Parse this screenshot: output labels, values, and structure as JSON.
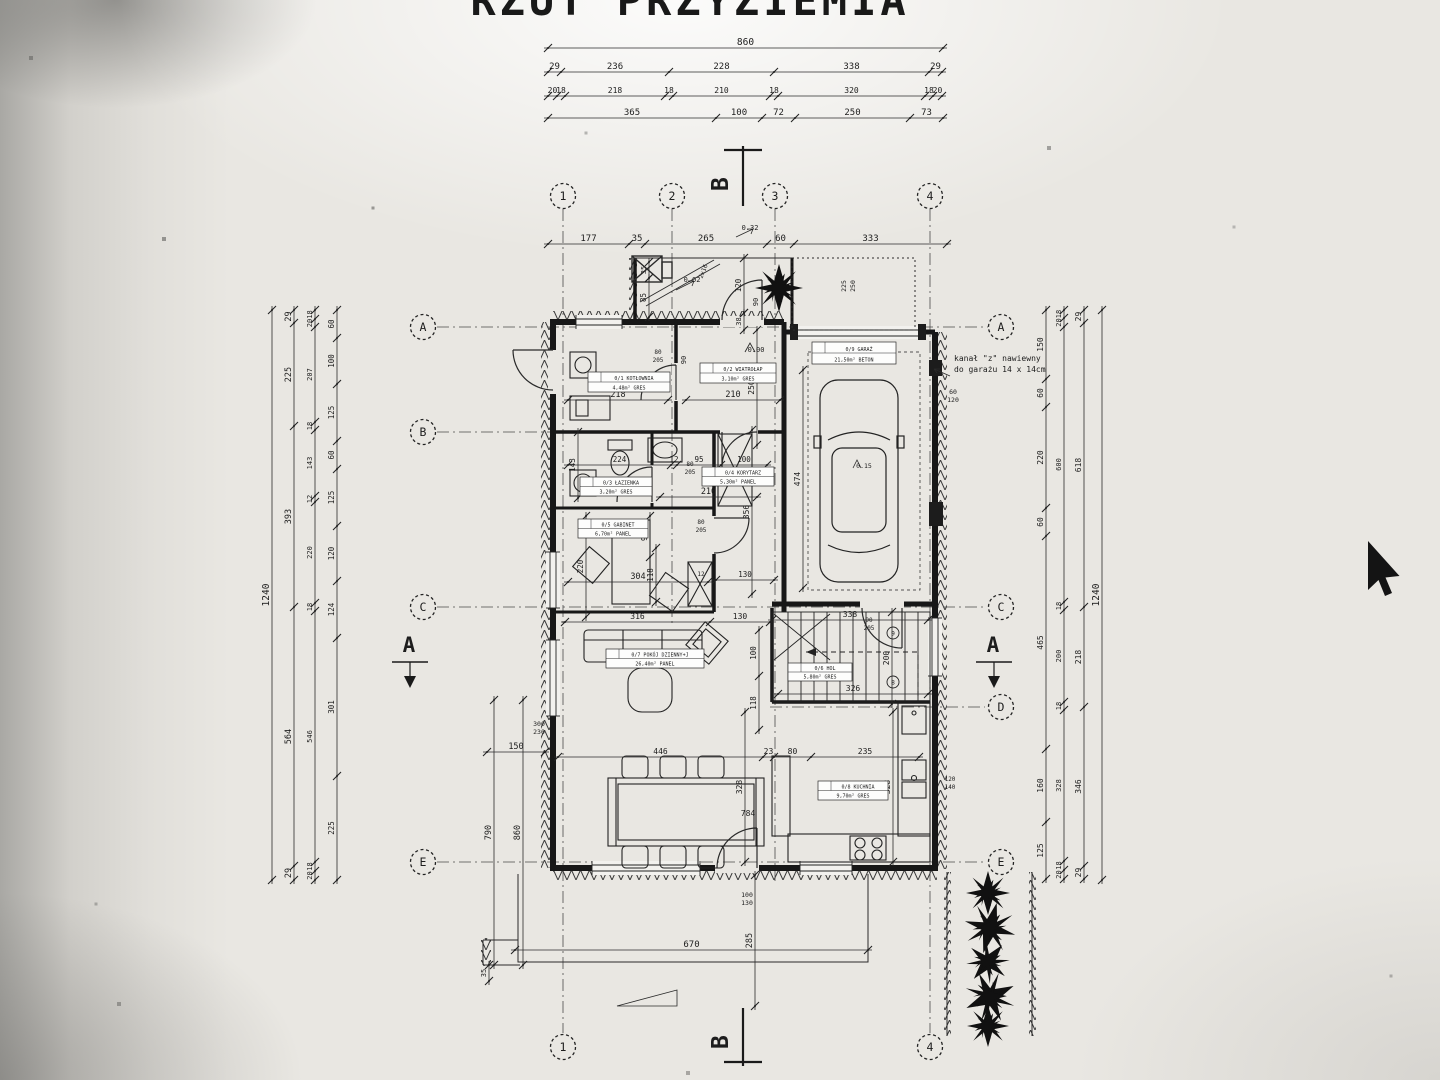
{
  "title": "RZUT PRZYZIEMIA",
  "note": {
    "line1": "kanał \"z\" nawiewny",
    "line2": "do garażu 14 x 14cm"
  },
  "grid": {
    "bubbles": [
      {
        "t": "1",
        "x": 563,
        "y": 196
      },
      {
        "t": "2",
        "x": 672,
        "y": 196
      },
      {
        "t": "3",
        "x": 775,
        "y": 196
      },
      {
        "t": "4",
        "x": 930,
        "y": 196
      },
      {
        "t": "A",
        "x": 423,
        "y": 327
      },
      {
        "t": "B",
        "x": 423,
        "y": 432
      },
      {
        "t": "C",
        "x": 423,
        "y": 607
      },
      {
        "t": "E",
        "x": 423,
        "y": 862
      },
      {
        "t": "A",
        "x": 1001,
        "y": 327
      },
      {
        "t": "C",
        "x": 1001,
        "y": 607
      },
      {
        "t": "D",
        "x": 1001,
        "y": 707
      },
      {
        "t": "E",
        "x": 1001,
        "y": 862
      },
      {
        "t": "1",
        "x": 563,
        "y": 1047
      },
      {
        "t": "4",
        "x": 930,
        "y": 1047
      }
    ]
  },
  "chains": [
    {
      "v": 0,
      "p": 48,
      "b": [
        548,
        943
      ],
      "l": [
        "860"
      ],
      "s": 9.5
    },
    {
      "v": 0,
      "p": 72,
      "b": [
        548,
        561,
        669,
        774,
        929,
        942
      ],
      "l": [
        "29",
        "236",
        "228",
        "338",
        "29"
      ],
      "s": 9
    },
    {
      "v": 0,
      "p": 96,
      "b": [
        548,
        557,
        565,
        665,
        673,
        770,
        778,
        925,
        933,
        942
      ],
      "l": [
        "20",
        "18",
        "218",
        "18",
        "210",
        "18",
        "320",
        "18",
        "20"
      ],
      "s": 8
    },
    {
      "v": 0,
      "p": 118,
      "b": [
        548,
        716,
        762,
        795,
        910,
        943
      ],
      "l": [
        "365",
        "100",
        "72",
        "250",
        "73"
      ],
      "s": 9
    },
    {
      "v": 0,
      "p": 244,
      "b": [
        548,
        629,
        645,
        767,
        794,
        947
      ],
      "l": [
        "177",
        "35",
        "265",
        "60",
        "333"
      ],
      "s": 9
    },
    {
      "v": 0,
      "p": 752,
      "b": [
        487,
        545
      ],
      "l": [
        "150"
      ],
      "s": 8.5
    },
    {
      "v": 0,
      "p": 950,
      "b": [
        515,
        868
      ],
      "l": [
        "670"
      ],
      "s": 9
    },
    {
      "v": 0,
      "p": 400,
      "b": [
        568,
        668
      ],
      "l": [
        "218"
      ],
      "s": 8.5
    },
    {
      "v": 0,
      "p": 400,
      "b": [
        686,
        780
      ],
      "l": [
        "210"
      ],
      "s": 8.5
    },
    {
      "v": 0,
      "p": 497,
      "b": [
        660,
        757
      ],
      "l": [
        "210"
      ],
      "s": 8.5
    },
    {
      "v": 0,
      "p": 465,
      "b": [
        568,
        671,
        677,
        721,
        767
      ],
      "l": [
        "224",
        "12",
        "95",
        "100"
      ],
      "s": 7.5
    },
    {
      "v": 0,
      "p": 582,
      "b": [
        568,
        708
      ],
      "l": [
        "304"
      ],
      "s": 8.5
    },
    {
      "v": 0,
      "p": 622,
      "b": [
        565,
        710,
        770
      ],
      "l": [
        "316",
        "130"
      ],
      "s": 8
    },
    {
      "v": 0,
      "p": 580,
      "b": [
        716,
        774
      ],
      "l": [
        "130"
      ],
      "s": 7.5
    },
    {
      "v": 0,
      "p": 757,
      "b": [
        558,
        763,
        774,
        811,
        919
      ],
      "l": [
        "446",
        "23",
        "80",
        "235"
      ],
      "s": 8
    },
    {
      "v": 0,
      "p": 620,
      "b": [
        772,
        928
      ],
      "l": [
        "338"
      ],
      "s": 8
    },
    {
      "v": 0,
      "p": 694,
      "b": [
        778,
        928
      ],
      "l": [
        "326"
      ],
      "s": 8
    },
    {
      "v": 1,
      "p": 272,
      "b": [
        310,
        880
      ],
      "l": [
        "1240"
      ],
      "s": 9.5
    },
    {
      "v": 1,
      "p": 294,
      "b": [
        310,
        323,
        426,
        607,
        866,
        880
      ],
      "l": [
        "29",
        "225",
        "393",
        "564",
        "29"
      ],
      "s": 8.5
    },
    {
      "v": 1,
      "p": 315,
      "b": [
        310,
        319,
        327,
        422,
        430,
        496,
        502,
        603,
        611,
        862,
        871,
        880
      ],
      "l": [
        "18",
        "20",
        "207",
        "18",
        "143",
        "12",
        "220",
        "18",
        "546",
        "18",
        "20"
      ],
      "s": 7
    },
    {
      "v": 1,
      "p": 337,
      "b": [
        310,
        338,
        384,
        441,
        469,
        526,
        581,
        638,
        776,
        880
      ],
      "l": [
        "60",
        "100",
        "125",
        "60",
        "125",
        "120",
        "124",
        "301",
        "225"
      ],
      "s": 7.5
    },
    {
      "v": 1,
      "p": 1046,
      "b": [
        310,
        379,
        407,
        508,
        536,
        749,
        822,
        879
      ],
      "l": [
        "150",
        "60",
        "220",
        "60",
        "465",
        "160",
        "125"
      ],
      "s": 8
    },
    {
      "v": 1,
      "p": 1064,
      "b": [
        310,
        318,
        327,
        602,
        610,
        702,
        710,
        861,
        870,
        879
      ],
      "l": [
        "18",
        "20",
        "600",
        "18",
        "200",
        "18",
        "328",
        "18",
        "20"
      ],
      "s": 7
    },
    {
      "v": 1,
      "p": 1084,
      "b": [
        310,
        323,
        607,
        707,
        866,
        879
      ],
      "l": [
        "29",
        "618",
        "218",
        "346",
        "29"
      ],
      "s": 8
    },
    {
      "v": 1,
      "p": 1102,
      "b": [
        310,
        880
      ],
      "l": [
        "1240"
      ],
      "s": 9.5
    },
    {
      "v": 1,
      "p": 494,
      "b": [
        700,
        965
      ],
      "l": [
        "790"
      ],
      "s": 8.5
    },
    {
      "v": 1,
      "p": 523,
      "b": [
        700,
        965
      ],
      "l": [
        "860"
      ],
      "s": 8.5
    },
    {
      "v": 1,
      "p": 755,
      "b": [
        875,
        1006
      ],
      "l": [
        "285"
      ],
      "s": 8.5
    },
    {
      "v": 1,
      "p": 489,
      "b": [
        965,
        981
      ],
      "l": [
        "35"
      ],
      "s": 7
    },
    {
      "v": 1,
      "p": 803,
      "b": [
        370,
        588
      ],
      "l": [
        "474"
      ],
      "s": 8
    },
    {
      "v": 1,
      "p": 892,
      "b": [
        612,
        704
      ],
      "l": [
        "200"
      ],
      "s": 8
    },
    {
      "v": 1,
      "p": 757,
      "b": [
        330,
        445
      ],
      "l": [
        "250"
      ],
      "s": 8
    },
    {
      "v": 1,
      "p": 759,
      "b": [
        630,
        676,
        730
      ],
      "l": [
        "100",
        "118"
      ],
      "s": 7.5
    },
    {
      "v": 1,
      "p": 745,
      "b": [
        712,
        862
      ],
      "l": [
        "328"
      ],
      "s": 8
    },
    {
      "v": 1,
      "p": 893,
      "b": [
        712,
        862
      ],
      "l": [
        "328"
      ],
      "s": 8
    },
    {
      "v": 1,
      "p": 752,
      "b": [
        430,
        594
      ],
      "l": [
        "356"
      ],
      "s": 8
    },
    {
      "v": 1,
      "p": 650,
      "b": [
        516,
        557
      ],
      "l": [
        "90"
      ],
      "s": 7.5
    },
    {
      "v": 1,
      "p": 586,
      "b": [
        516,
        617
      ],
      "l": [
        "220"
      ],
      "s": 7.5
    },
    {
      "v": 1,
      "p": 656,
      "b": [
        548,
        602
      ],
      "l": [
        "118"
      ],
      "s": 7.5
    },
    {
      "v": 1,
      "p": 578,
      "b": [
        432,
        498
      ],
      "l": [
        "143"
      ],
      "s": 7.5
    },
    {
      "v": 1,
      "p": 649,
      "b": [
        262,
        278
      ],
      "l": [
        "35"
      ],
      "s": 7
    },
    {
      "v": 1,
      "p": 649,
      "b": [
        278,
        317
      ],
      "l": [
        "85"
      ],
      "s": 7.5
    },
    {
      "v": 1,
      "p": 744,
      "b": [
        258,
        313
      ],
      "l": [
        "120"
      ],
      "s": 7.5
    },
    {
      "v": 1,
      "p": 744,
      "b": [
        313,
        330
      ],
      "l": [
        "38"
      ],
      "s": 7
    }
  ],
  "labels": [
    {
      "t": "B",
      "x": 728,
      "y": 184,
      "r": -90,
      "s": 23,
      "bold": 1
    },
    {
      "t": "B",
      "x": 728,
      "y": 1042,
      "r": -90,
      "s": 23,
      "bold": 1
    },
    {
      "t": "A",
      "x": 409,
      "y": 652,
      "s": 21,
      "bold": 1
    },
    {
      "t": "A",
      "x": 993,
      "y": 652,
      "s": 21,
      "bold": 1
    },
    {
      "t": "2x16",
      "x": 705,
      "y": 272,
      "r": -68,
      "s": 6
    },
    {
      "t": "0.02",
      "x": 692,
      "y": 282,
      "s": 7
    },
    {
      "t": "0.32",
      "x": 750,
      "y": 230,
      "s": 7
    },
    {
      "t": "0.00",
      "x": 756,
      "y": 352,
      "s": 7
    },
    {
      "t": "0.15",
      "x": 864,
      "y": 468,
      "s": 6.5
    },
    {
      "t": "90",
      "x": 686,
      "y": 360,
      "r": -90,
      "s": 7
    },
    {
      "t": "80",
      "x": 658,
      "y": 354,
      "s": 6
    },
    {
      "t": "205",
      "x": 658,
      "y": 362,
      "s": 6
    },
    {
      "t": "80",
      "x": 690,
      "y": 466,
      "s": 6
    },
    {
      "t": "205",
      "x": 690,
      "y": 474,
      "s": 6
    },
    {
      "t": "80",
      "x": 701,
      "y": 524,
      "s": 6
    },
    {
      "t": "205",
      "x": 701,
      "y": 532,
      "s": 6
    },
    {
      "t": "90",
      "x": 869,
      "y": 622,
      "s": 6
    },
    {
      "t": "205",
      "x": 869,
      "y": 630,
      "s": 6
    },
    {
      "t": "90",
      "x": 758,
      "y": 302,
      "r": -90,
      "s": 7
    },
    {
      "t": "60",
      "x": 953,
      "y": 394,
      "s": 6.5
    },
    {
      "t": "120",
      "x": 953,
      "y": 402,
      "s": 6.5
    },
    {
      "t": "225",
      "x": 846,
      "y": 286,
      "r": -90,
      "s": 6.5
    },
    {
      "t": "250",
      "x": 855,
      "y": 286,
      "r": -90,
      "s": 6.5
    },
    {
      "t": "784",
      "x": 748,
      "y": 816,
      "s": 8
    },
    {
      "t": "120",
      "x": 950,
      "y": 781,
      "s": 6
    },
    {
      "t": "140",
      "x": 950,
      "y": 789,
      "s": 6
    },
    {
      "t": "300",
      "x": 539,
      "y": 726,
      "s": 6.5
    },
    {
      "t": "230",
      "x": 539,
      "y": 734,
      "s": 6.5
    },
    {
      "t": "100",
      "x": 747,
      "y": 897,
      "s": 6.5
    },
    {
      "t": "130",
      "x": 747,
      "y": 905,
      "s": 6.5
    },
    {
      "t": "12",
      "x": 701,
      "y": 576,
      "s": 6
    },
    {
      "t": "9",
      "x": 893,
      "y": 635.5,
      "s": 6
    },
    {
      "t": "8",
      "x": 893,
      "y": 684.5,
      "s": 6
    },
    {
      "t": "kanał \"z\" nawiewny",
      "x": 954,
      "y": 361,
      "s": 8,
      "a": 1
    },
    {
      "t": "do garażu 14 x 14cm",
      "x": 954,
      "y": 372,
      "s": 8,
      "a": 1
    }
  ],
  "rooms": [
    {
      "a": "0/1 KOTŁOWNIA",
      "b": "4,48m² GRES",
      "x": 588,
      "y": 372,
      "w": 82,
      "h": 20
    },
    {
      "a": "0/2 WIATROŁAP",
      "b": "3,10m² GRES",
      "x": 700,
      "y": 363,
      "w": 76,
      "h": 20
    },
    {
      "a": "0/3 ŁAZIENKA",
      "b": "3,20m² GRES",
      "x": 580,
      "y": 477,
      "w": 72,
      "h": 19
    },
    {
      "a": "0/4 KORYTARZ",
      "b": "5,30m² PANEL",
      "x": 702,
      "y": 467,
      "w": 72,
      "h": 19
    },
    {
      "a": "0/5 GABINET",
      "b": "6,70m² PANEL",
      "x": 578,
      "y": 519,
      "w": 70,
      "h": 19
    },
    {
      "a": "0/7 POKÓJ DZIENNY+J",
      "b": "26,40m² PANEL",
      "x": 606,
      "y": 649,
      "w": 98,
      "h": 19
    },
    {
      "a": "0/6 HOL",
      "b": "5,80m² GRES",
      "x": 788,
      "y": 663,
      "w": 64,
      "h": 18
    },
    {
      "a": "0/8 KUCHNIA",
      "b": "9,70m² GRES",
      "x": 818,
      "y": 781,
      "w": 70,
      "h": 19
    },
    {
      "a": "0/9 GARAŻ",
      "b": "21,50m² BETON",
      "x": 812,
      "y": 342,
      "w": 84,
      "h": 22
    }
  ]
}
